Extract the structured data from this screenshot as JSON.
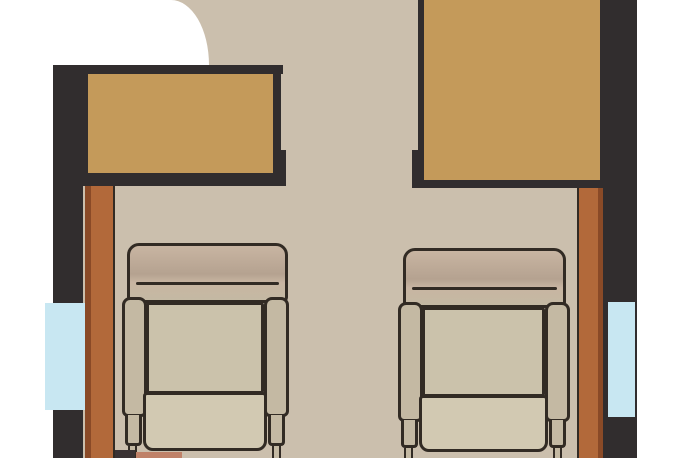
{
  "meta": {
    "type": "floorplan-detail",
    "description": "Top-down floorplan crop showing two forward-facing captain chairs behind two wall-mounted tables, with side windows and sideboard strips"
  },
  "colors": {
    "background": "#ffffff",
    "floor": "#cbbfad",
    "wall": "#312d2e",
    "outline": "#322b24",
    "table": "#c49a5a",
    "sideboard": "#b2693a",
    "sideboard_shadow": "#8a4a27",
    "window": "#c8e7f2",
    "backrest": "#b5a290",
    "backrest_highlight": "#c8b5a2",
    "armrest": "#c4b9a3",
    "cushion": "#cbc2ab",
    "cushion_lower": "#d2c9b2",
    "salmon": "#bf8168",
    "fragment_dark": "#3a3233"
  },
  "objects": [
    {
      "name": "floor",
      "kind": "surface"
    },
    {
      "name": "exterior-corner",
      "kind": "outside-area"
    },
    {
      "name": "left-wall",
      "kind": "wall"
    },
    {
      "name": "right-wall",
      "kind": "wall"
    },
    {
      "name": "top-wall-band",
      "kind": "wall"
    },
    {
      "name": "left-window",
      "kind": "window"
    },
    {
      "name": "right-window",
      "kind": "window"
    },
    {
      "name": "left-sideboard",
      "kind": "furniture"
    },
    {
      "name": "right-sideboard",
      "kind": "furniture"
    },
    {
      "name": "left-table",
      "kind": "table"
    },
    {
      "name": "right-table",
      "kind": "table"
    },
    {
      "name": "left-seat",
      "kind": "captain-chair"
    },
    {
      "name": "right-seat",
      "kind": "captain-chair"
    }
  ]
}
